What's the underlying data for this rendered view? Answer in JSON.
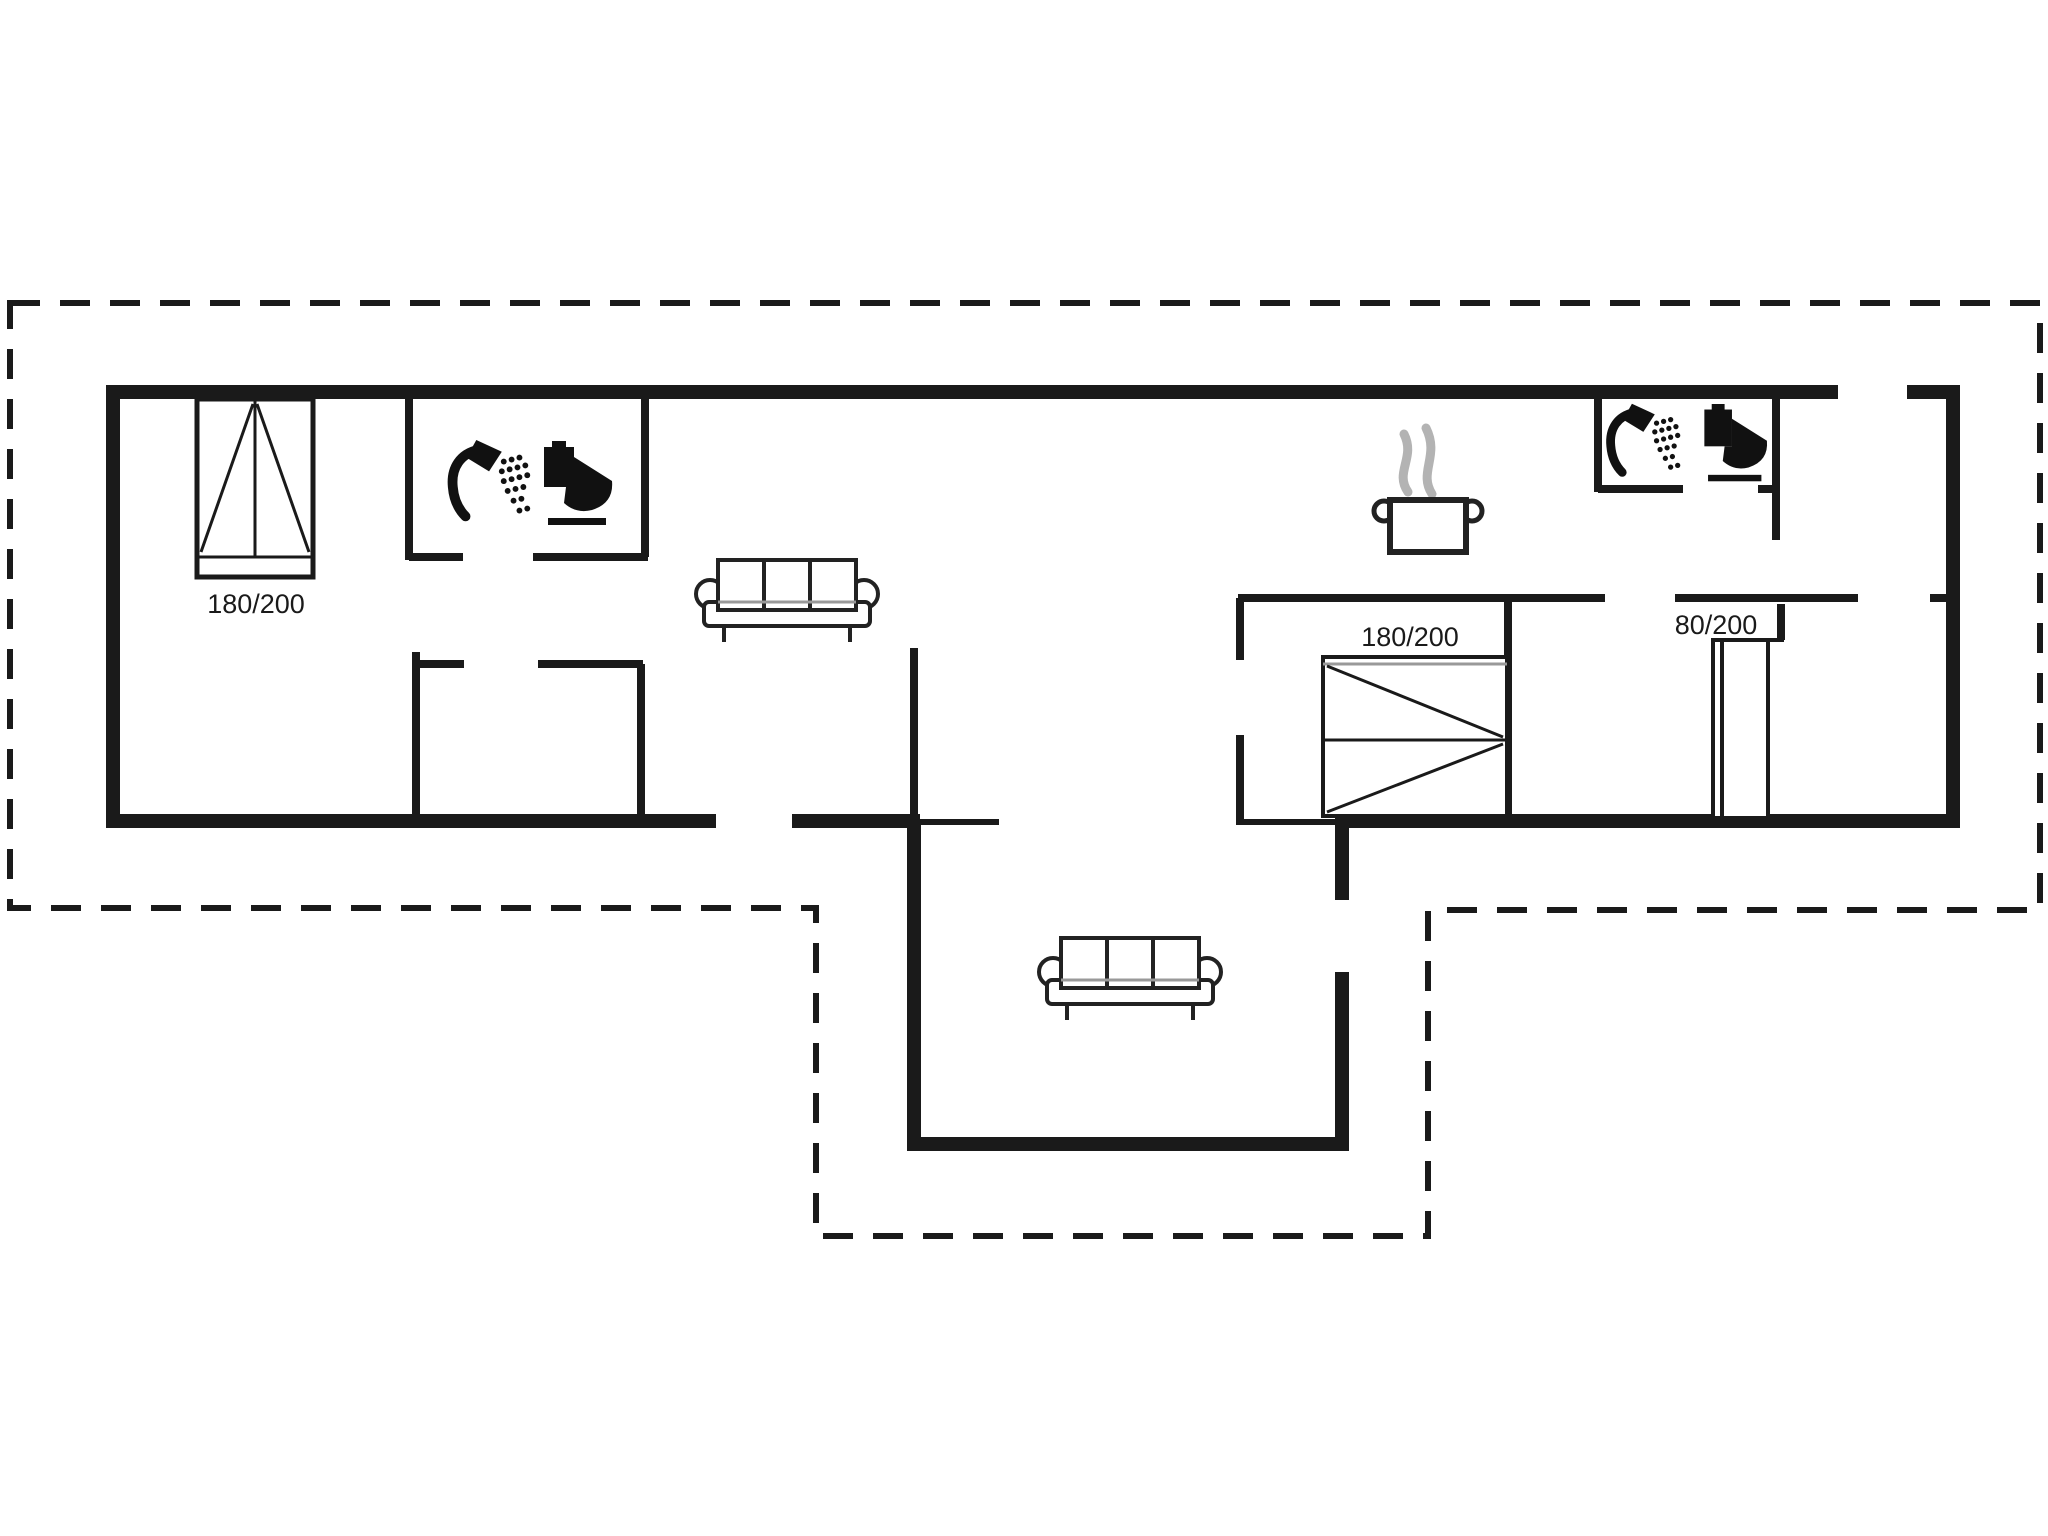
{
  "plan": {
    "background_color": "#ffffff",
    "wall_color": "#1a1a1a",
    "steam_color": "#b3b3b3",
    "bed_headboard_color": "#999999",
    "labels": {
      "left_bed": "180/200",
      "right_bed": "180/200",
      "bunk_bed": "80/200"
    },
    "icons": {
      "shower_left": "shower-icon",
      "toilet_left": "toilet-icon",
      "shower_right": "shower-icon",
      "toilet_right": "toilet-icon",
      "cooking_pot": "cooking-pot-icon",
      "steam": "steam-icon",
      "sofa_living_room": "sofa-icon",
      "sofa_annex": "sofa-icon",
      "double_bed_left": "double-bed-icon",
      "double_bed_right": "double-bed-icon",
      "single_bed": "single-bed-icon"
    }
  }
}
